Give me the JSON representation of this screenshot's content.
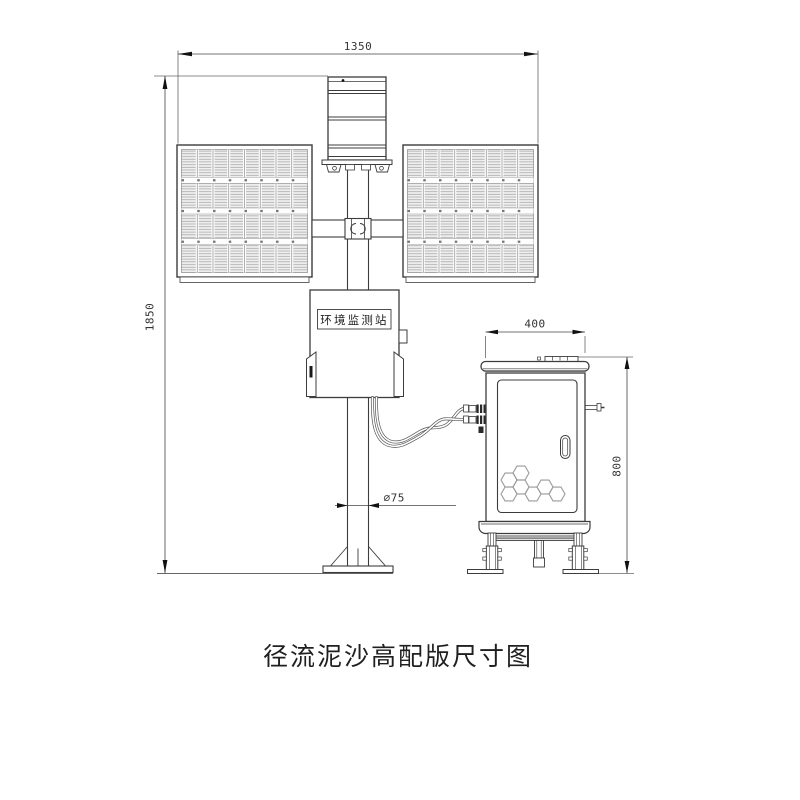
{
  "drawing": {
    "title": "径流泥沙高配版尺寸图",
    "station_label": "环境监测站",
    "dimensions": {
      "top_width": "1350",
      "pole_height": "1850",
      "cabinet_width": "400",
      "cabinet_height": "800",
      "pole_diameter": "∅75"
    },
    "colors": {
      "line": "#3c3c3c",
      "dimension_line": "#555555",
      "background": "#ffffff"
    }
  }
}
